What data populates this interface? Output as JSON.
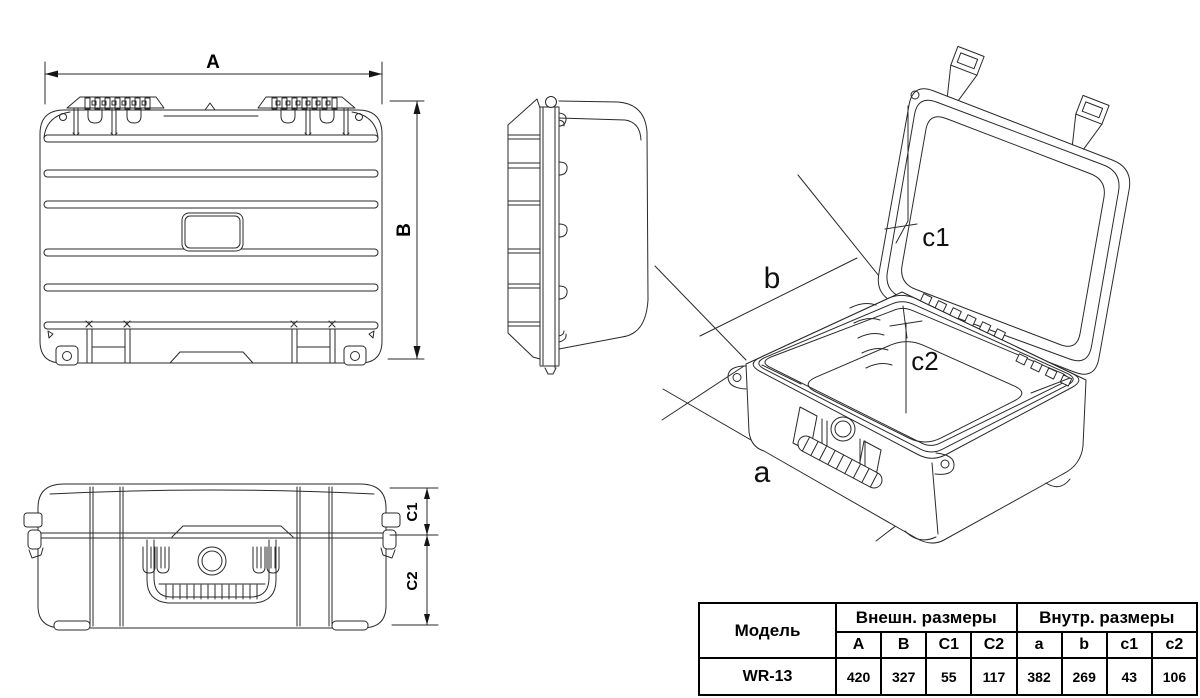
{
  "drawing": {
    "front_view": {
      "width_label": "A",
      "height_label": "B"
    },
    "side_profile_view": {
      "lid_height_label": "C1",
      "body_height_label": "C2"
    },
    "iso_view": {
      "inner_length_label": "a",
      "inner_width_label": "b",
      "inner_lid_depth_label": "c1",
      "inner_body_depth_label": "c2"
    }
  },
  "table": {
    "model_header": "Модель",
    "external_header": "Внешн. размеры",
    "internal_header": "Внутр. размеры",
    "external_columns": [
      "A",
      "B",
      "C1",
      "C2"
    ],
    "internal_columns": [
      "a",
      "b",
      "c1",
      "c2"
    ],
    "rows": [
      {
        "model": "WR-13",
        "values": [
          "420",
          "327",
          "55",
          "117",
          "382",
          "269",
          "43",
          "106"
        ]
      }
    ]
  },
  "colors": {
    "line": "#2a2a2a",
    "text": "#000000",
    "background": "#ffffff"
  }
}
